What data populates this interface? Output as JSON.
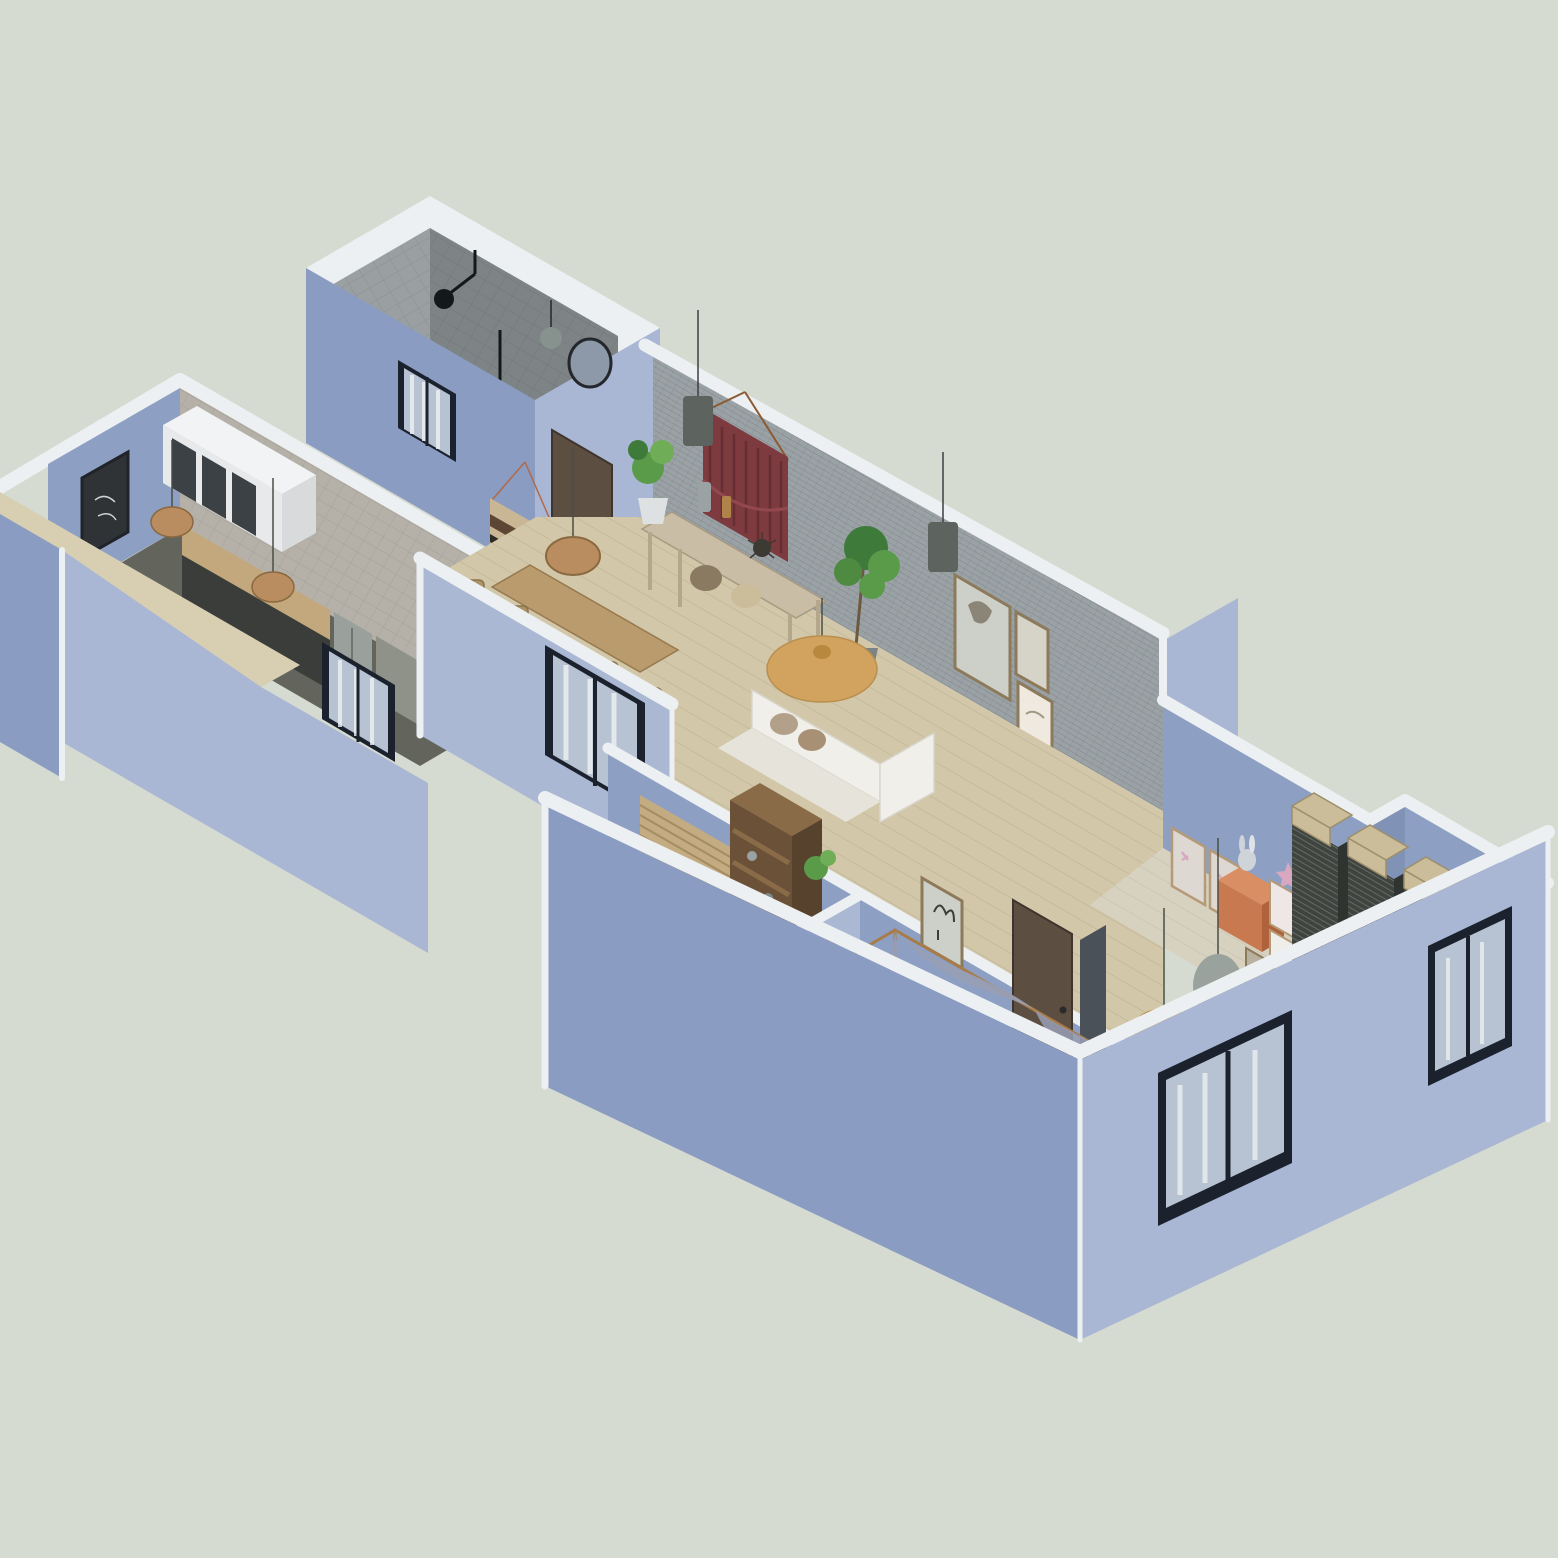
{
  "scene": {
    "type": "isometric-apartment-cutaway-3d-floorplan",
    "background": "empty sage canvas, no text or UI controls visible",
    "rooms": [
      {
        "name": "bathroom",
        "items": [
          "gray-wall-tiles",
          "walk-in-shower-fixture",
          "round-mirror",
          "sphere-pendant-lamp",
          "exterior-window"
        ]
      },
      {
        "name": "kitchen",
        "items": [
          "white-upper-cabinets-glass-doors",
          "wood-countertop",
          "refrigerator",
          "gray-appliance-unit",
          "rattan-pendant-light-pair",
          "dark-wall-art",
          "potted-plant",
          "travertine-half-wall-top",
          "exterior-window"
        ]
      },
      {
        "name": "dining-area",
        "items": [
          "wood-dining-table",
          "rattan-chairs",
          "rattan-dome-pendant",
          "striped-woven-wall-hanging",
          "entry-door",
          "exterior-window"
        ]
      },
      {
        "name": "living-room",
        "items": [
          "gray-brick-feature-wall",
          "burgundy-macrame-hanging",
          "drum-pendant-lamp-pair",
          "console-table-with-vases",
          "gallery-picture-frames",
          "white-sofa",
          "tan-pillows",
          "gold-disc-pendant-lamp",
          "tall-ficus-plant",
          "fiddle-leaf-fig",
          "arched-mirror-niche"
        ]
      },
      {
        "name": "study",
        "items": [
          "tall-wood-bookshelf",
          "rattan-window-blind",
          "potted-plant"
        ]
      },
      {
        "name": "master-bedroom",
        "items": [
          "four-poster-canopy-bed",
          "draped-canopy-fabric",
          "olive-pillows",
          "blue-blanket",
          "gold-disc-pendant-lamp",
          "egg-pendant-lamp",
          "gold-frame-mirror",
          "storage-cubbies-with-baskets",
          "dark-wood-door",
          "dark-curtain",
          "botanical-art-frame"
        ]
      },
      {
        "name": "kids-room",
        "items": [
          "terracotta-dresser",
          "bunny-plush",
          "letter-posters",
          "small-picture-frame-cluster",
          "star-ornament"
        ]
      },
      {
        "name": "closet-nook",
        "items": [
          "dark-slatted-wardrobe-columns",
          "woven-storage-baskets"
        ]
      }
    ],
    "exterior": {
      "window_count": 5,
      "window_style": "black-framed sliding windows with sheer curtains",
      "wall_style": "periwinkle-blue plaster walls with white cut-top trim"
    }
  },
  "colors": {
    "bg": "#d6dbd1",
    "trim": "#edf0f2",
    "wallLeft": "#8a9cc2",
    "wallRight": "#a9b7d4",
    "wallInner": "#8d9fc2",
    "wallInnerLight": "#aab8d4",
    "wallDeep": "#8092b6",
    "brick": "#9ba2a6",
    "brickLine": "#5a6066",
    "tileLight": "#9aa0a2",
    "tileDark": "#7e8486",
    "tileFloor": "#a8acad",
    "beigeTop": "#d8cfb2",
    "floorWood": "#d2c7a9",
    "floorBed": "#d7d1c0",
    "floorKids": "#cfc9b7",
    "floorKitchen": "#63655c",
    "doorWood": "#5c4e41",
    "frameDark": "#1b222e",
    "glass": "#b7c3d2",
    "curtain": "#eef1f2",
    "gold": "#d2a35e",
    "goldDark": "#b9883f",
    "sofa": "#f0efe9",
    "pillowTan": "#b3a08b",
    "macrame": "#7d3b40",
    "macrameDark": "#5e2c31",
    "plant": "#5a9b4a",
    "plantDark": "#3e7a3a",
    "pot": "#7b8388",
    "potWhite": "#dde1e2",
    "rattan": "#b98d5f",
    "woodMid": "#c9bda6",
    "woodTable": "#b99b6e",
    "shelfWood": "#6b5138",
    "shelfSide": "#57422d",
    "shelfTop": "#8a6b47",
    "basket": "#cbbd9a",
    "slat": "#3f4440",
    "slatLine": "#6e746a",
    "bedBase": "#e9e7de",
    "blanket": "#8d9bb0",
    "pillowOlive": "#8a8f72",
    "drape": "#989eb6",
    "eggLamp": "#99a29c",
    "mirrorGlass": "#8d98a8",
    "mirrorGold": "#b08d4f",
    "dresser": "#c97950",
    "dresserTop": "#d98e63",
    "dresserSide": "#b0623c",
    "posterBg": "#ded8d2",
    "posterFrame": "#b59a78",
    "artBg": "#cdd0c8",
    "artFrame": "#8c7a5a",
    "artDark": "#2f3336",
    "cabinetWhite": "#e8e9ea",
    "cabinetGlass": "#3c4146",
    "steel": "#9aa09c",
    "grayUnit": "#8e9288",
    "counter": "#c2a87c",
    "lampGray": "#5d635f",
    "sphereGray": "#87918d",
    "curtainDark": "#4a5158",
    "pink": "#d8a8c0",
    "shadow": "#6f7480"
  }
}
